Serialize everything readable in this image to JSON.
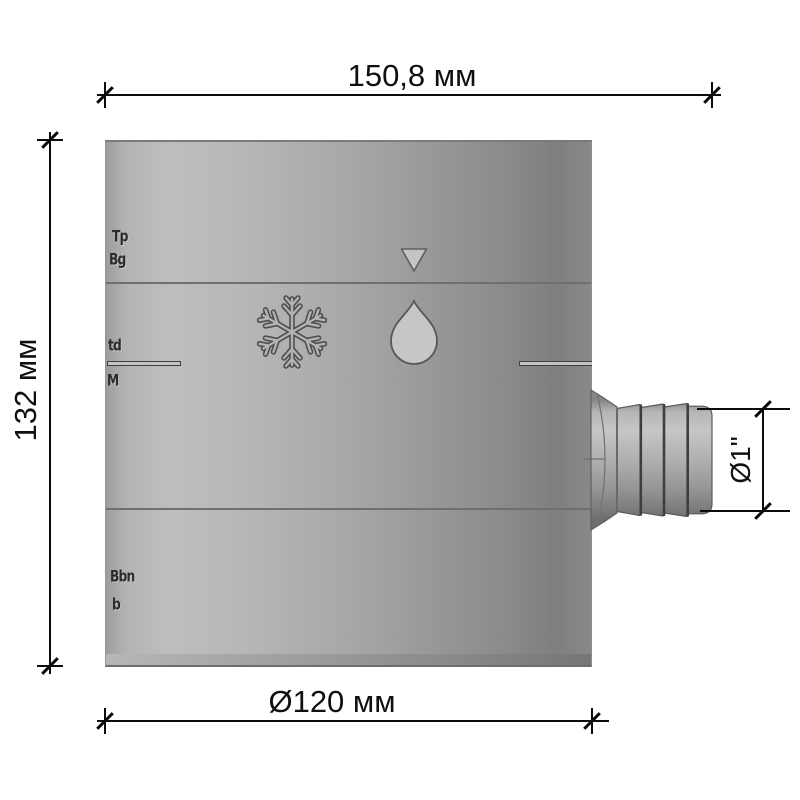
{
  "dimensions": {
    "width_total": "150,8 мм",
    "height": "132 мм",
    "diameter_body": "Ø120 мм",
    "outlet": "Ø1\""
  },
  "icons": {
    "triangle": "fill-level-triangle",
    "snowflake": "frost-symbol",
    "drop": "water-drop-symbol"
  },
  "embossed_marks": [
    "Tp",
    "Bg",
    "td",
    "M",
    "Bbn",
    "b"
  ],
  "colors": {
    "body_light": "#bdbfbf",
    "body_dark": "#7f7f7f",
    "symbol_fill": "#c6c6c6",
    "symbol_outline": "#585858",
    "dimension": "#0c0c0c"
  }
}
